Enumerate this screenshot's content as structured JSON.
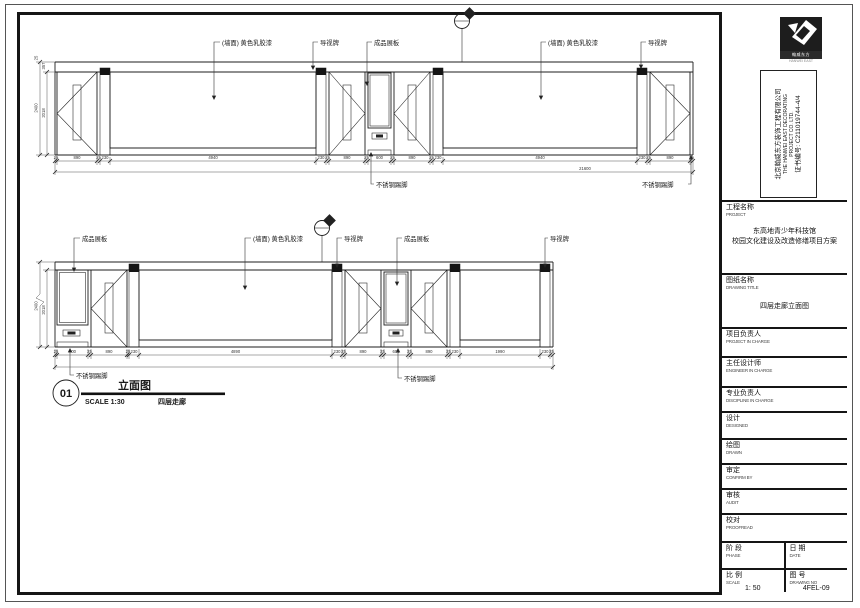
{
  "title_block": {
    "logo_caption": "翰威东方",
    "logo_sub": "HANWEI EAST",
    "company": {
      "cn": "北京翰威东方装饰工程有限公司",
      "en1": "THE HANWEI EAST DECORATING",
      "en2": "PROJECT CO. LTD.",
      "cert": "证书编号: C211019744-4/4"
    },
    "project": {
      "label_cn": "工程名称",
      "label_en": "PROJECT",
      "value_line1": "东高地青少年科技馆",
      "value_line2": "校园文化建设及改造修缮项目方案"
    },
    "drawing_title": {
      "label_cn": "图纸名称",
      "label_en": "DRAWING TITLE",
      "value": "四层走廊立面图"
    },
    "fields": [
      {
        "cn": "项目负责人",
        "en": "PROJECT IN CHARGE"
      },
      {
        "cn": "主任设计师",
        "en": "ENGINEER IN CHARGE"
      },
      {
        "cn": "专业负责人",
        "en": "DISCIPLINE IN CHARGE"
      },
      {
        "cn": "设计",
        "en": "DESIGNED"
      },
      {
        "cn": "绘图",
        "en": "DRAWN"
      },
      {
        "cn": "审定",
        "en": "CONFIRM BY"
      },
      {
        "cn": "审核",
        "en": "AUDIT"
      },
      {
        "cn": "校对",
        "en": "PROOFREAD"
      }
    ],
    "phase": {
      "cn": "阶 段",
      "en": "PHASE"
    },
    "date": {
      "cn": "日 期",
      "en": "DATE"
    },
    "scale": {
      "cn": "比 例",
      "en": "SCALE",
      "value": "1: 50"
    },
    "drawing_no": {
      "cn": "图 号",
      "en": "DRAWING NO",
      "value": "4FEL-09"
    }
  },
  "labels": {
    "wall_paint": "(墙面) 黄色乳胶漆",
    "sign_board": "导视牌",
    "display_board": "成品展板",
    "skirting": "不锈钢踢脚"
  },
  "view": {
    "number": "01",
    "title": "立面图",
    "scale_text": "SCALE 1:30",
    "location": "四层走廊"
  },
  "top_drawing": {
    "dims": [
      "25",
      "890",
      "25",
      "230",
      "4940",
      "230",
      "25",
      "890",
      "25",
      "600",
      "25",
      "890",
      "25",
      "230",
      "4940",
      "230",
      "25",
      "890",
      "25"
    ],
    "total": "21600",
    "height_total": "2400",
    "height_opening": "2018",
    "height_top_a": "25",
    "height_top_b": "357"
  },
  "bottom_drawing": {
    "dims": [
      "25",
      "700",
      "25",
      "890",
      "25",
      "230",
      "4890",
      "230",
      "25",
      "890",
      "25",
      "600",
      "25",
      "890",
      "25",
      "230",
      "1990",
      "230",
      "25"
    ],
    "height_total": "2400",
    "height_opening": "2018"
  }
}
